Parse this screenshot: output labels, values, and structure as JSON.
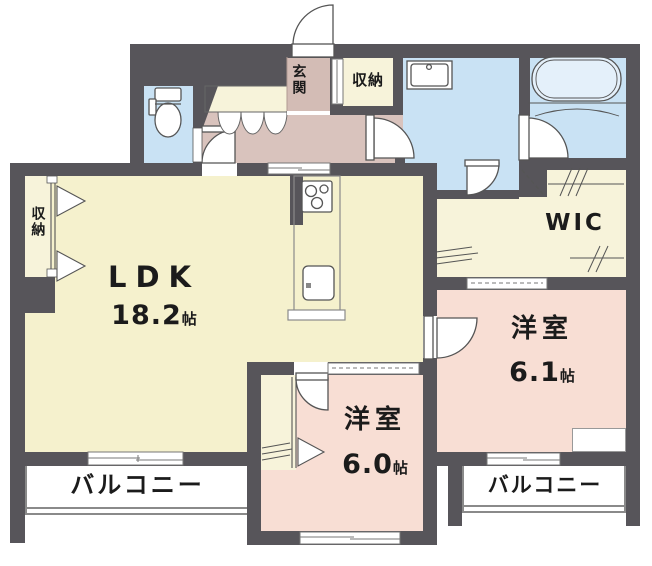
{
  "plan_title": "apartment-floor-plan",
  "colors": {
    "wall": "#57555a",
    "floor": "#f5f1cd",
    "closet": "#f7f3da",
    "hall": "#d9c3bd",
    "genkan": "#d3bcb5",
    "bedroom": "#f8ded4",
    "water": "#c9e2f4",
    "tub": "#e4f0fa",
    "ink": "#1b1b1b"
  },
  "rooms": {
    "ldk": {
      "label": "LDK",
      "size_value": "18.2",
      "size_unit": "帖"
    },
    "bedroom_right": {
      "label": "洋室",
      "size_value": "6.1",
      "size_unit": "帖"
    },
    "bedroom_bottom": {
      "label": "洋室",
      "size_value": "6.0",
      "size_unit": "帖"
    },
    "wic": {
      "label": "WIC"
    },
    "entrance": {
      "label": "玄関"
    },
    "entrance_storage": {
      "label": "収納"
    },
    "ldk_storage": {
      "label": "収納"
    },
    "balcony_left": {
      "label": "バルコニー"
    },
    "balcony_right": {
      "label": "バルコニー"
    }
  }
}
